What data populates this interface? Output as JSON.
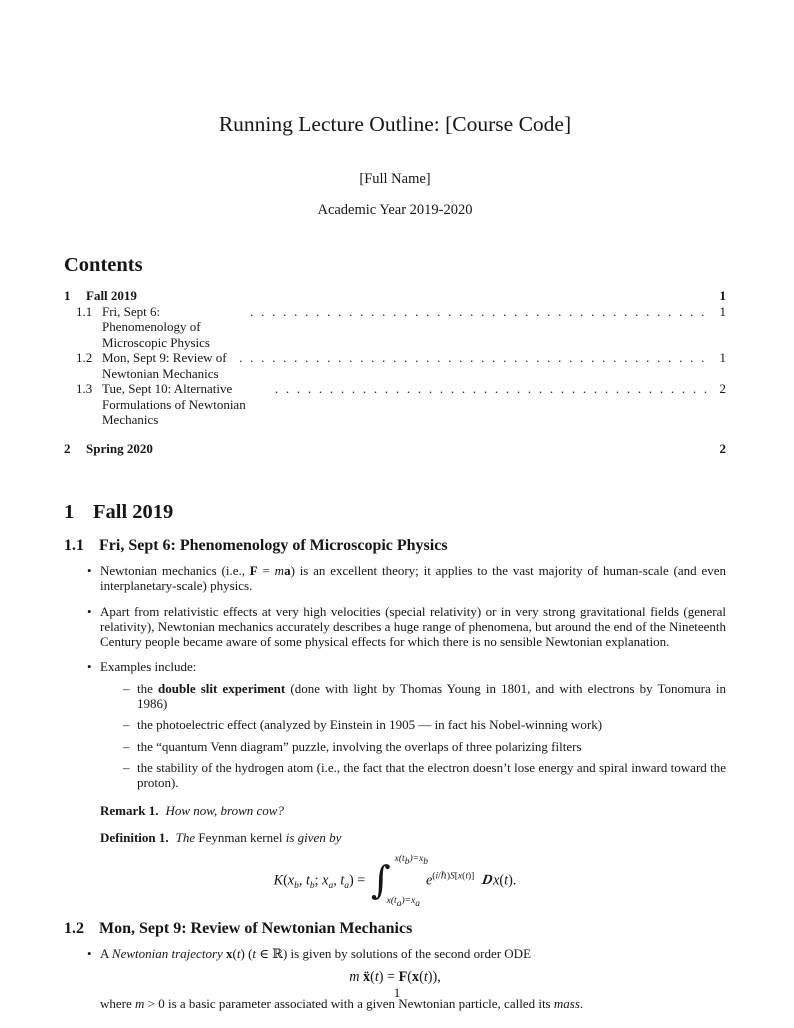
{
  "header": {
    "title": "Running Lecture Outline: [Course Code]",
    "author": "[Full Name]",
    "date": "Academic Year 2019-2020"
  },
  "contents": {
    "heading": "Contents",
    "entries": [
      {
        "number": "1",
        "title": "Fall 2019",
        "page": "1"
      },
      {
        "number": "1.1",
        "title": "Fri, Sept 6: Phenomenology of Microscopic Physics",
        "page": "1"
      },
      {
        "number": "1.2",
        "title": "Mon, Sept 9: Review of Newtonian Mechanics",
        "page": "1"
      },
      {
        "number": "1.3",
        "title": "Tue, Sept 10: Alternative Formulations of Newtonian Mechanics",
        "page": "2"
      },
      {
        "number": "2",
        "title": "Spring 2020",
        "page": "2"
      }
    ]
  },
  "section1": {
    "number": "1",
    "title": "Fall 2019",
    "sub1": {
      "number": "1.1",
      "title": "Fri, Sept 6: Phenomenology of Microscopic Physics",
      "bullet1_html": "Newtonian mechanics (i.e., <b>F</b> = <i>m</i><b>a</b>) is an excellent theory; it applies to the vast majority of human-scale (and even interplanetary-scale) physics.",
      "bullet2_html": "Apart from relativistic effects at very high velocities (special relativity) or in very strong gravitational fields (general relativity), Newtonian mechanics accurately describes a huge range of phenomena, but around the end of the Nineteenth Century people became aware of some physical effects for which there is no sensible Newtonian explanation.",
      "bullet3_html": "Examples include:",
      "examples": [
        {
          "html": "the <b>double slit experiment</b> (done with light by Thomas Young in 1801, and with electrons by Tonomura in 1986)"
        },
        {
          "html": "the photoelectric effect (analyzed by Einstein in 1905 — in fact his Nobel-winning work)"
        },
        {
          "html": "the “quantum Venn diagram” puzzle, involving the overlaps of three polarizing filters"
        },
        {
          "html": "the stability of the hydrogen atom (i.e., the fact that the electron doesn’t lose energy and spiral inward toward the proton)."
        }
      ],
      "remark_label": "Remark 1.",
      "remark_text": "How now, brown cow?",
      "definition_label": "Definition 1.",
      "definition_html": "<i>The</i> Feynman kernel <i>is given by</i>",
      "equation_html": "<i>K</i>(<i>x</i><sub>b</sub>, <i>t</i><sub>b</sub>; <i>x</i><sub>a</sub>, <i>t</i><sub>a</sub>) = <span class=\"intwrap\"><span class=\"intsign\">∫</span><span class=\"lims\"><span class=\"lim\"><i>x</i>(<i>t</i><sub>b</sub>)=<i>x</i><sub>b</sub></span><span class=\"lim\"><i>x</i>(<i>t</i><sub>a</sub>)=<i>x</i><sub>a</sub></span></span></span><i>e</i><sup>(<i>i</i>/ℏ)<i>S</i>[<i>x</i>(<i>t</i>)]</sup> <span class=\"scrD\">D</span><i>x</i>(<i>t</i>)."
    },
    "sub2": {
      "number": "1.2",
      "title": "Mon, Sept 9: Review of Newtonian Mechanics",
      "bullet1_html": "A <i>Newtonian trajectory</i> <b>x</b>(<i>t</i>) (<i>t</i> ∈ ℝ) is given by solutions of the second order ODE",
      "equation_html": "<i>m</i> <b>ẍ</b>(<i>t</i>) = <b>F</b>(<b>x</b>(<i>t</i>)),",
      "after_html": "where <i>m</i> > 0 is a basic parameter associated with a given Newtonian particle, called its <i>mass</i>."
    }
  },
  "footer": {
    "page": "1"
  }
}
